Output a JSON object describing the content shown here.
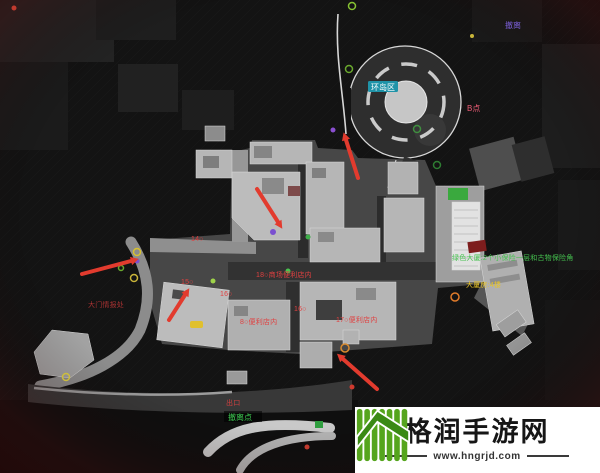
{
  "watermark": {
    "site_name": "格润手游网",
    "site_url": "www.hngrjd.com",
    "logo_icon": "green-bars-rising-arrow"
  },
  "colors": {
    "arrow_red": "#e23b2e",
    "plaza_gray": "#474747",
    "building_gray": "#b6b6b6",
    "road_dark": "#383838",
    "roundabout_island": "#c6c6c6",
    "green_patch": "#3aa93e",
    "red_roof": "#7d1d1d"
  },
  "annotations": {
    "region_badge": {
      "text": "环岛区",
      "bg": "#1f93a8",
      "color": "#ffffff"
    },
    "labels": [
      {
        "id": "gate-note",
        "text": "大门情报处",
        "color": "#a83232"
      },
      {
        "id": "marker-14",
        "text": "14○",
        "color": "#e04040"
      },
      {
        "id": "marker-15",
        "text": "15○",
        "color": "#e04040"
      },
      {
        "id": "marker-16",
        "text": "16○",
        "color": "#e04040"
      },
      {
        "id": "marker-16b",
        "text": "16○",
        "color": "#e04040"
      },
      {
        "id": "shop-18",
        "text": "18○商场便利店内",
        "color": "#e04040"
      },
      {
        "id": "shop-8",
        "text": "8○便利店内",
        "color": "#e04040"
      },
      {
        "id": "shop-17",
        "text": "17○便利店内",
        "color": "#e04040"
      },
      {
        "id": "tower-note",
        "text": "大厦房:4楼",
        "color": "#e7c327"
      },
      {
        "id": "green-building",
        "text": "绿色大厦:2个小保险一层和古物保险角",
        "color": "#45c24f"
      },
      {
        "id": "exit-northeast",
        "text": "撤离",
        "color": "#7b5fd8"
      },
      {
        "id": "point-b",
        "text": "B点",
        "color": "#ef5d77"
      },
      {
        "id": "exit-south",
        "text": "撤离点",
        "color": "#3ecb52"
      },
      {
        "id": "exit-south-small",
        "text": "出口",
        "color": "#d04040"
      }
    ],
    "markers": [
      {
        "name": "ring-green-top",
        "shape": "ring",
        "color": "#86c232"
      },
      {
        "name": "ring-green-upper",
        "shape": "ring",
        "color": "#6aa82e"
      },
      {
        "name": "ring-green-roundabout",
        "shape": "ring",
        "color": "#3f8f3f"
      },
      {
        "name": "ring-green-lower",
        "shape": "ring",
        "color": "#2e7d32"
      },
      {
        "name": "ring-yellow-left-1",
        "shape": "ring",
        "color": "#d8c22e"
      },
      {
        "name": "dot-purple-left",
        "shape": "dot",
        "color": "#7a4fd0"
      },
      {
        "name": "ring-yellow-left-2",
        "shape": "ring",
        "color": "#c9b43a"
      },
      {
        "name": "ring-green-left",
        "shape": "ring",
        "color": "#6aa82e"
      },
      {
        "name": "dot-purple-road",
        "shape": "dot",
        "color": "#8a4fd0"
      },
      {
        "name": "dot-purple-center",
        "shape": "dot",
        "color": "#7a4fd0"
      },
      {
        "name": "dot-green-center-1",
        "shape": "dot",
        "color": "#3fae4a"
      },
      {
        "name": "dot-green-center-2",
        "shape": "dot",
        "color": "#49c24f"
      },
      {
        "name": "dot-green-center-3",
        "shape": "dot",
        "color": "#9fd34a"
      },
      {
        "name": "ring-orange-tower",
        "shape": "ring",
        "color": "#e07b2a"
      },
      {
        "name": "ring-orange-south",
        "shape": "ring",
        "color": "#d98a2e"
      },
      {
        "name": "ring-yellow-southwest",
        "shape": "ring",
        "color": "#cdbd3c"
      },
      {
        "name": "dot-yellow-northeast",
        "shape": "dot",
        "color": "#c9b53a"
      },
      {
        "name": "dot-red-south",
        "shape": "dot",
        "color": "#d03a2e"
      },
      {
        "name": "dot-red-bottom",
        "shape": "dot",
        "color": "#c03a2e"
      },
      {
        "name": "square-green-bottom",
        "shape": "square",
        "color": "#2f9e3f"
      },
      {
        "name": "pill-yellow",
        "shape": "pill",
        "color": "#e0c02e"
      },
      {
        "name": "dot-red-topleft",
        "shape": "dot",
        "color": "#c03a2e"
      }
    ],
    "arrows": [
      {
        "name": "arrow-west",
        "points": "east"
      },
      {
        "name": "arrow-left-cluster",
        "points": "northeast"
      },
      {
        "name": "arrow-center",
        "points": "southeast"
      },
      {
        "name": "arrow-roundabout",
        "points": "north"
      },
      {
        "name": "arrow-south",
        "points": "northwest"
      }
    ]
  }
}
